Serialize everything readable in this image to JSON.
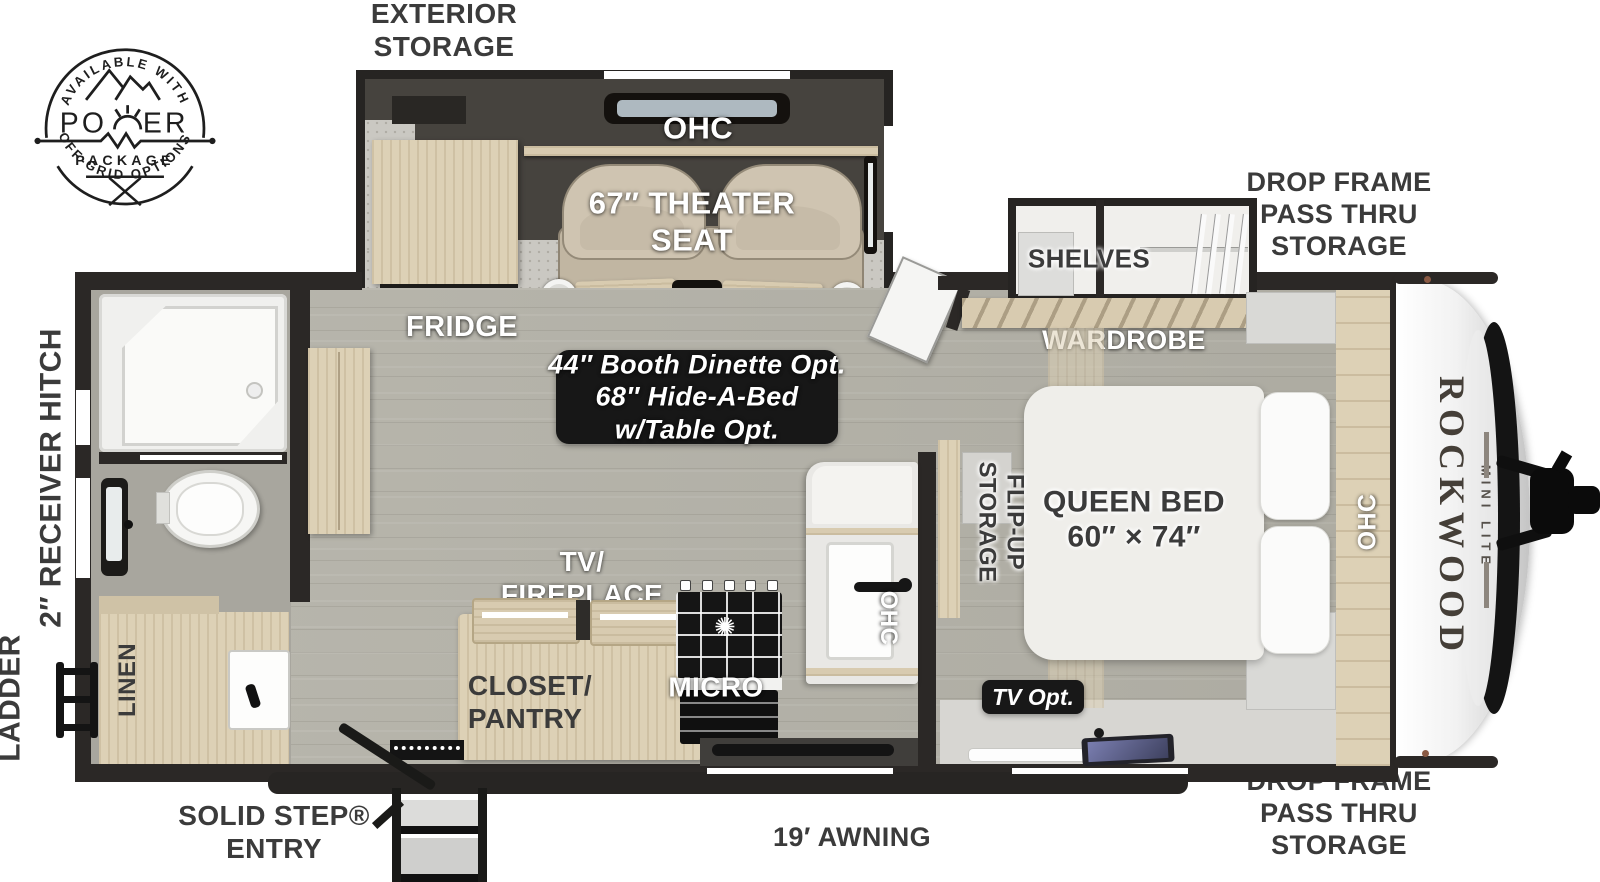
{
  "badge": {
    "arc_top": "AVAILABLE WITH",
    "word_left": "PO",
    "word_right": "ER",
    "subtitle": "PACKAGE",
    "arc_bottom": "OFF-GRID OPTIONS"
  },
  "labels": {
    "exterior_storage": {
      "l1": "EXTERIOR",
      "l2": "STORAGE"
    },
    "drop_frame": {
      "l1": "DROP FRAME",
      "l2": "PASS THRU",
      "l3": "STORAGE"
    },
    "ohc": "OHC",
    "theater_seat": {
      "l1": "67″ THEATER",
      "l2": "SEAT"
    },
    "fridge": "FRIDGE",
    "shelves": "SHELVES",
    "wardrobe": "WARDROBE",
    "dinette": {
      "l1": "44″ Booth Dinette Opt.",
      "l2": "68″ Hide-A-Bed",
      "l3": "w/Table Opt."
    },
    "queen_bed": {
      "l1": "QUEEN BED",
      "l2": "60″ × 74″"
    },
    "flip_up": {
      "l1": "FLIP-UP",
      "l2": "STORAGE"
    },
    "tv_fireplace": {
      "l1": "TV/",
      "l2": "FIREPLACE"
    },
    "closet_pantry": {
      "l1": "CLOSET/",
      "l2": "PANTRY"
    },
    "micro": "MICRO",
    "tv_opt": "TV Opt.",
    "linen": "LINEN",
    "receiver_hitch": "2″ RECEIVER HITCH",
    "ladder": "LADDER",
    "solid_step": {
      "l1": "SOLID STEP®",
      "l2": "ENTRY"
    },
    "awning": "19′ AWNING",
    "console_icon": "H"
  },
  "brand": {
    "name": "ROCKWOOD",
    "sub": "MINI LITE"
  },
  "colors": {
    "wall": "#2b2826",
    "wood": "#ddd1b6",
    "floor": "#b4b2a8",
    "carpet": "#cac8c2",
    "seat": "#c6bba8",
    "label_dark": "#3b3b3b",
    "option_box": "#171717",
    "cap_white": "#f4f4f4"
  }
}
